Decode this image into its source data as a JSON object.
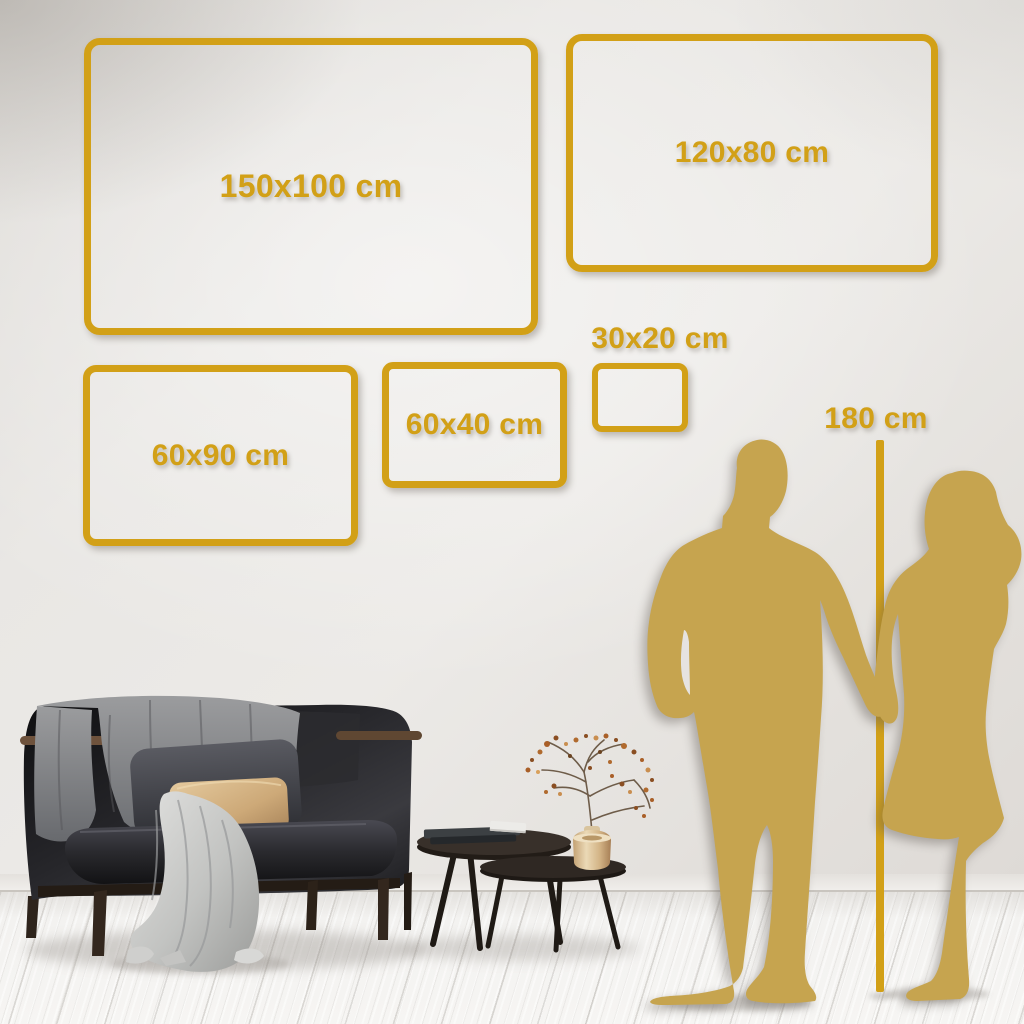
{
  "image_title": "Wall art size comparison guide",
  "colors": {
    "gold": "#D2A017",
    "silhouette": "#C6A44F",
    "wall": "#E8E5E2",
    "floor": "#F5F4F2"
  },
  "size_options": [
    {
      "label": "150x100 cm",
      "width_cm": 150,
      "height_cm": 100
    },
    {
      "label": "120x80 cm",
      "width_cm": 120,
      "height_cm": 80
    },
    {
      "label": "60x90 cm",
      "width_cm": 60,
      "height_cm": 90
    },
    {
      "label": "60x40 cm",
      "width_cm": 60,
      "height_cm": 40
    },
    {
      "label": "30x20 cm",
      "width_cm": 30,
      "height_cm": 20
    }
  ],
  "height_reference": {
    "label": "180 cm",
    "height_cm": 180
  },
  "scene_items": [
    "sofa",
    "blanket",
    "pillows",
    "nesting-coffee-tables",
    "books",
    "brass-vase-with-dried-branch",
    "couple-silhouette-holding-hands"
  ]
}
